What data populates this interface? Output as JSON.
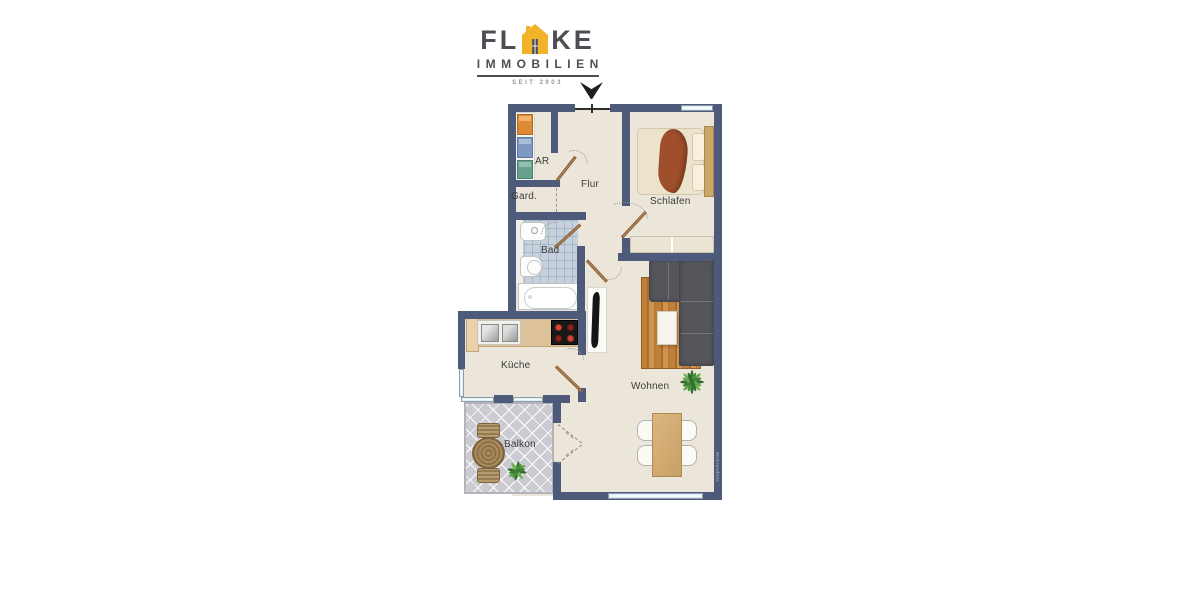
{
  "brand": {
    "name_prefix": "FL",
    "name_suffix": "KE",
    "subtitle": "IMMOBILIEN",
    "tagline": "SEIT 2003",
    "accent_color": "#F2B32A",
    "text_color": "#4B4F54"
  },
  "floor_plan": {
    "wall_color": "#4E5A7A",
    "floor_color": "#ECE6DA",
    "bath_tile_color": "#C7D1DD",
    "balcony_tile_color": "#CBCBD1",
    "door_color": "#B98A5A",
    "window_color": "#DCECF2",
    "rooms": [
      {
        "id": "ar",
        "label": "AR"
      },
      {
        "id": "garderobe",
        "label": "Gard."
      },
      {
        "id": "flur",
        "label": "Flur"
      },
      {
        "id": "schlafen",
        "label": "Schlafen"
      },
      {
        "id": "bad",
        "label": "Bad"
      },
      {
        "id": "kueche",
        "label": "Küche"
      },
      {
        "id": "wohnen",
        "label": "Wohnen"
      },
      {
        "id": "balkon",
        "label": "Balkon"
      }
    ],
    "watermark": "McGrundriss"
  }
}
